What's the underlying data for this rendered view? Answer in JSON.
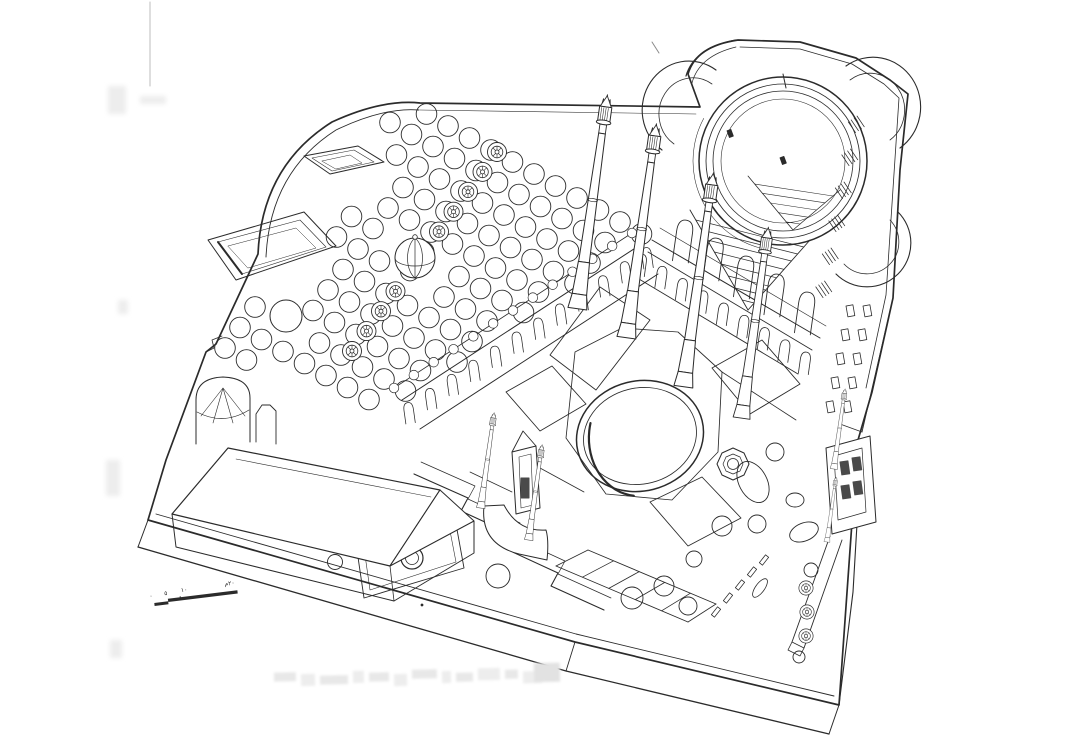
{
  "artwork": {
    "kind": "axonometric architectural line drawing (scanned ink on paper)",
    "subject": "Ottoman mosque complex seen from above: domed prayer hall, arcaded courtyard with circular pool, four tall minarets, walled garden with tree circles and a row of domed kiosks, hip-roofed bath building, gatehouse with twin small minarets, raised precinct platform"
  },
  "colors": {
    "paper": "#ffffff",
    "ink": "#2b2b2b",
    "faded_smudge": "#ececec"
  },
  "scale_bar": {
    "labels": [
      "٠",
      "٥",
      "١٠",
      "٢٠م"
    ]
  },
  "caption": {
    "legible": false,
    "note": "faded illegible caption line at bottom of sheet"
  }
}
